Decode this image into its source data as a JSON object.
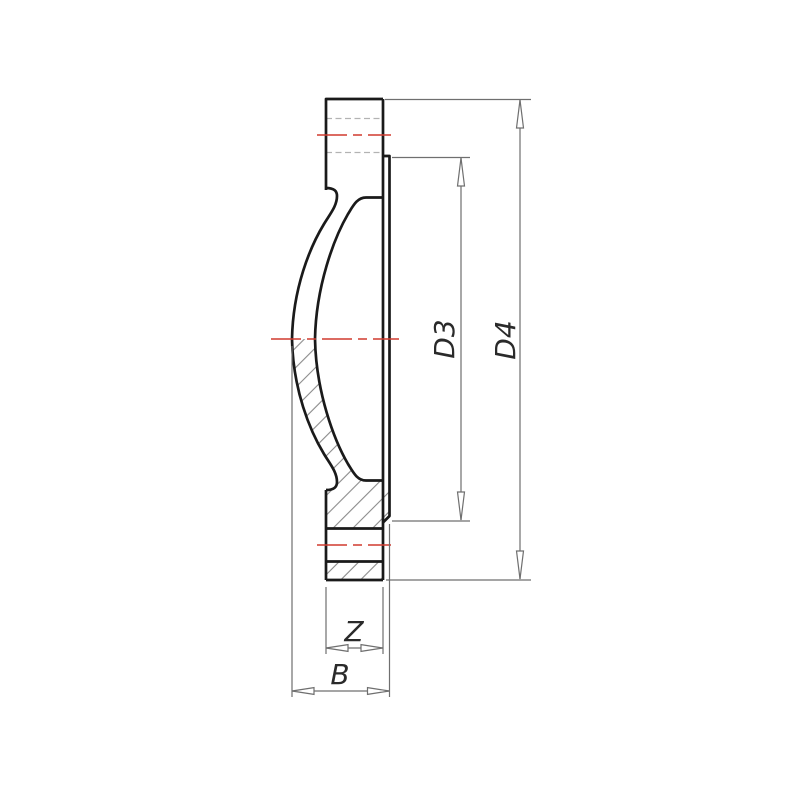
{
  "drawing": {
    "labels": {
      "diameter_inner": "D3",
      "diameter_outer": "D4",
      "hub_width": "Z",
      "total_width": "B"
    },
    "colors": {
      "outline": "#1a1a1a",
      "centerline_red": "#d03a2e",
      "dimension_gray": "#6f6f6f",
      "hidden_gray": "#b3b3b3",
      "hatch_gray": "#8a8a8a",
      "background": "#ffffff"
    }
  }
}
